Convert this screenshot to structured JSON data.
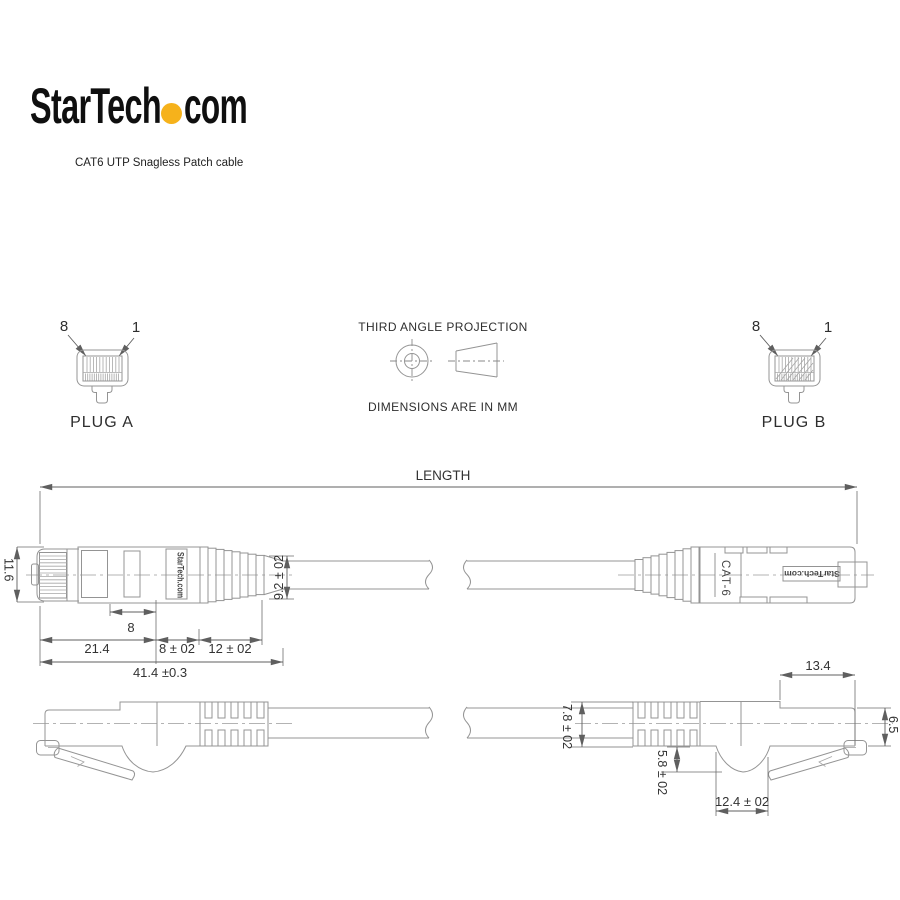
{
  "header": {
    "logo_text": "StarTech",
    "logo_tld": "com",
    "subtitle": "CAT6 UTP Snagless Patch cable"
  },
  "plugs": {
    "plug_a": {
      "pin_left": "8",
      "pin_right": "1",
      "caption": "PLUG A"
    },
    "plug_b": {
      "pin_left": "8",
      "pin_right": "1",
      "caption": "PLUG B"
    }
  },
  "projection": {
    "title": "THIRD ANGLE PROJECTION",
    "units_note": "DIMENSIONS ARE IN MM"
  },
  "dimensions": {
    "length": "LENGTH",
    "plug_height": "11.6",
    "contact_length": "8",
    "plug_body_length": "21.4",
    "collar_length": "8 ± 02",
    "relief_length": "12 ± 02",
    "overall_length": "41.4 ±0.3",
    "boot_diameter": "9.2 ± 02",
    "cable_diameter": "7.8 ± 02",
    "latch_depth": "5.8 ± 02",
    "boot_notch_width": "12.4 ± 02",
    "latch_length": "13.4",
    "tip_height": "6.5"
  },
  "labels": {
    "brand_boot": "StarTech.com",
    "brand_plate": "StarTech.com",
    "cable_type": "CAT-6"
  },
  "colors": {
    "logo_dot": "#F6B21B",
    "geometry_line": "#949494",
    "dimension_line": "#5f5f5f"
  }
}
